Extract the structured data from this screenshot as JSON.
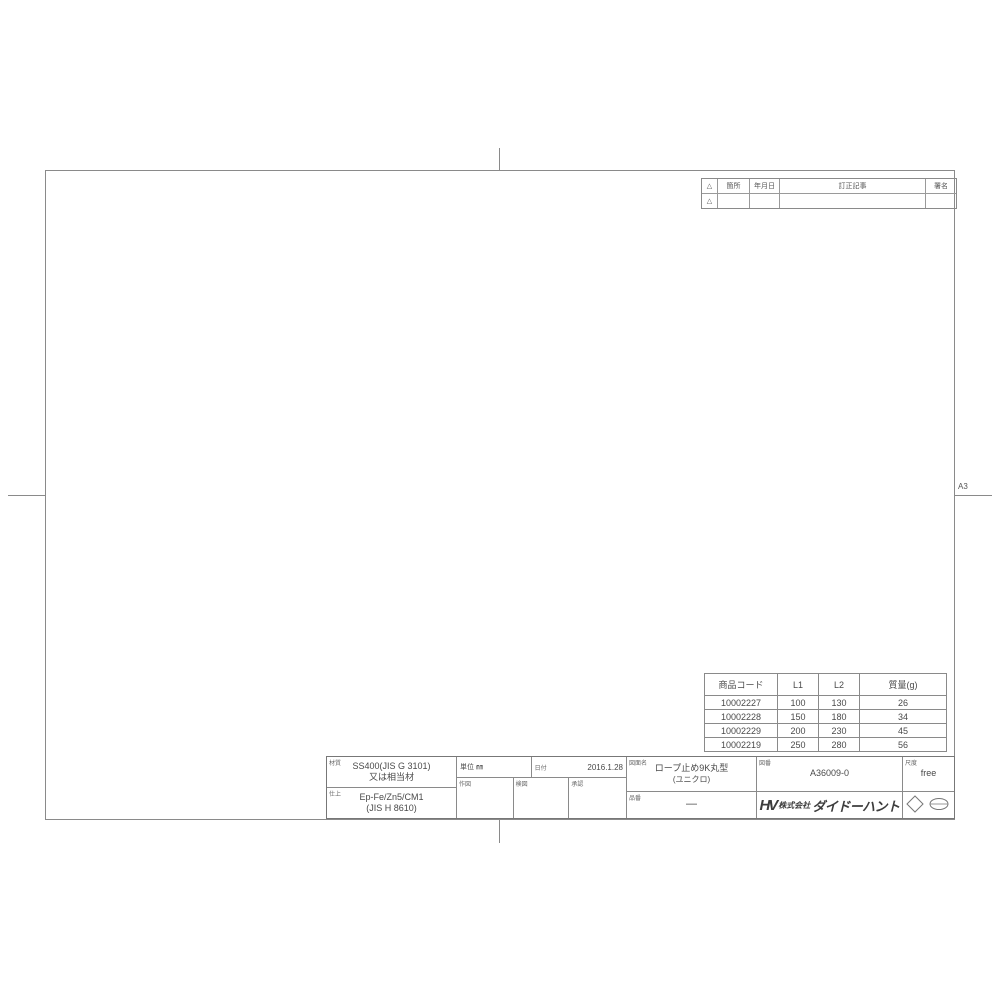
{
  "sheet": {
    "size_label": "A3"
  },
  "revision_table": {
    "mark_header": "△",
    "place_header": "箇所",
    "date_header": "年月日",
    "note_header": "訂正記事",
    "sign_header": "署名",
    "row2_mark": "△"
  },
  "drawing": {
    "dims": {
      "overall_length": "L2",
      "shaft_length": "L1",
      "tip_length": "(8)",
      "shaft_diameter": "6",
      "ring_inner_diameter": "φ17",
      "ring_outer_height": "30"
    }
  },
  "parts_table": {
    "headers": {
      "code": "商品コード",
      "l1": "L1",
      "l2": "L2",
      "mass": "質量(g)"
    },
    "rows": [
      {
        "code": "10002227",
        "l1": "100",
        "l2": "130",
        "mass": "26"
      },
      {
        "code": "10002228",
        "l1": "150",
        "l2": "180",
        "mass": "34"
      },
      {
        "code": "10002229",
        "l1": "200",
        "l2": "230",
        "mass": "45"
      },
      {
        "code": "10002219",
        "l1": "250",
        "l2": "280",
        "mass": "56"
      }
    ]
  },
  "title_block": {
    "material_label": "材質",
    "material_line1": "SS400(JIS G 3101)",
    "material_line2": "又は相当材",
    "finish_label": "仕上",
    "finish_line1": "Ep-Fe/Zn5/CM1",
    "finish_line2": "(JIS H 8610)",
    "unit_label": "単位 ㎜",
    "date_label": "日付",
    "date_value": "2016.1.28",
    "drawn_label": "作図",
    "checked_label": "検図",
    "approved_label": "承認",
    "name_label": "図面名",
    "name_line1": "ロープ止め9K丸型",
    "name_line2": "(ユニクロ)",
    "part_no_label": "品番",
    "part_no_value": "—",
    "dwg_no_label": "図番",
    "dwg_no_value": "A36009-0",
    "scale_label": "尺度",
    "scale_value": "free",
    "logo_text": "HV",
    "company_prefix": "株式会社",
    "company_name": "ダイドーハント"
  }
}
